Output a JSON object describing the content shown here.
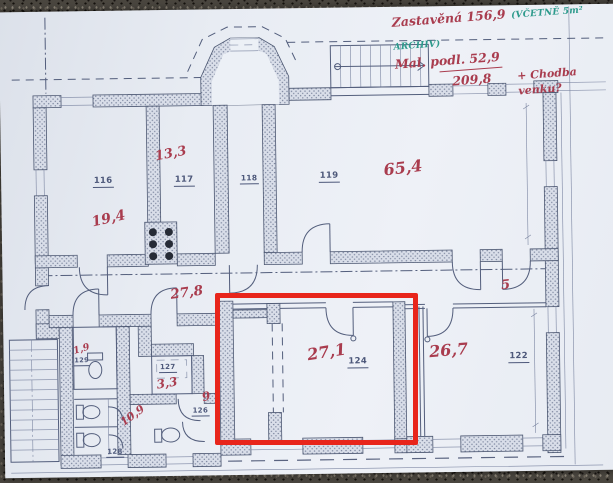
{
  "notes": {
    "built": "Zastavěná  156,9",
    "archive": "(VČETNĚ 5m² ARCHIV)",
    "floor": "Mal. podl.  52,9",
    "total": "209,8",
    "total_note": "+ Chodba venku?"
  },
  "rooms": {
    "r116": {
      "number": "116",
      "area": "19,4"
    },
    "r117": {
      "number": "117",
      "area": "13,3"
    },
    "r118": {
      "number": "118"
    },
    "r119": {
      "number": "119",
      "area": "65,4"
    },
    "r122": {
      "number": "122",
      "area": "26,7"
    },
    "r124": {
      "number": "124",
      "area": "27,1"
    },
    "r126": {
      "number": "126",
      "area": "9"
    },
    "r127": {
      "number": "127",
      "area": "3,3"
    },
    "r128": {
      "number": "128",
      "area": "10,9"
    },
    "r129": {
      "number": "129",
      "area": "1,9"
    },
    "corridor": {
      "area": "27,8"
    },
    "hall_right": {
      "area": "5"
    }
  },
  "colors": {
    "handwriting_red": "#a93c4e",
    "handwriting_green": "#2d9a8c",
    "highlight": "#e8251b",
    "paper": "#e9edf4",
    "ink": "#4d587a"
  }
}
